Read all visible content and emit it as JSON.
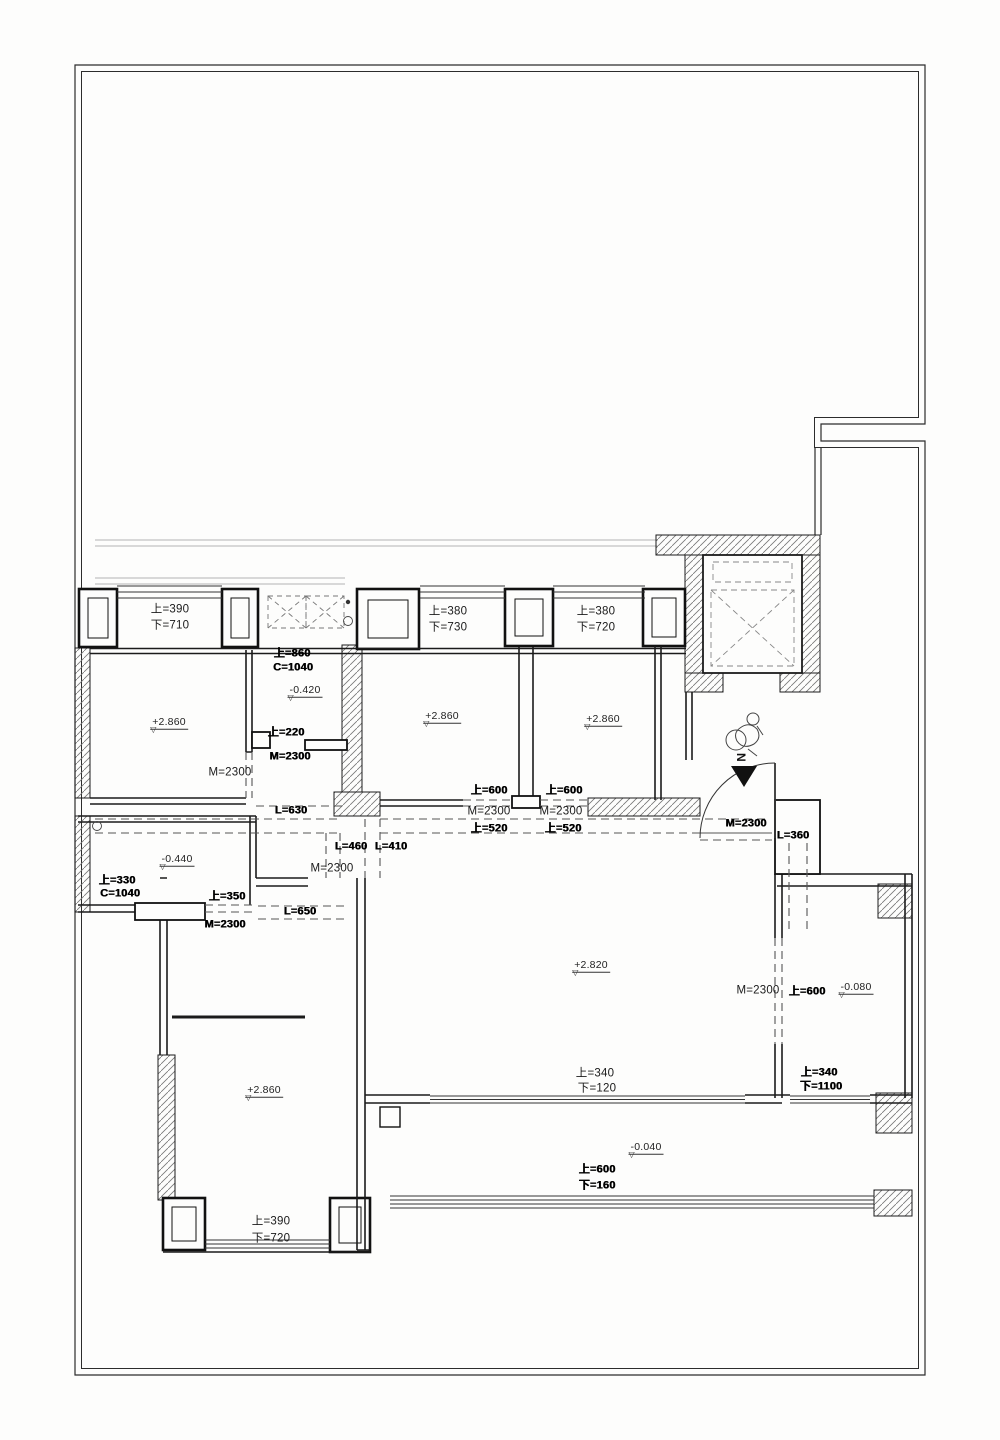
{
  "page": {
    "width": 1000,
    "height": 1440,
    "background": "#fdfdfc",
    "line_color": "#1b1b1b",
    "dash_color": "#555555",
    "hatch_color": "#666666"
  },
  "plan": {
    "type": "architectural-floor-plan",
    "north_arrow": {
      "label": "N"
    },
    "icons": [
      {
        "name": "north-arrow-icon",
        "meaning": "north direction arrow"
      },
      {
        "name": "person-figure-icon",
        "meaning": "entry person sketch"
      },
      {
        "name": "elevator-cross",
        "meaning": "elevator shaft with diagonal cross"
      }
    ],
    "annotations": [
      {
        "name": "window-sill-label",
        "text": "上=390",
        "x": 170,
        "y": 610,
        "style": "normal"
      },
      {
        "name": "window-sill-label",
        "text": "下=710",
        "x": 170,
        "y": 626,
        "style": "normal"
      },
      {
        "name": "window-sill-label",
        "text": "上=380",
        "x": 448,
        "y": 612,
        "style": "normal"
      },
      {
        "name": "window-sill-label",
        "text": "下=730",
        "x": 448,
        "y": 628,
        "style": "normal"
      },
      {
        "name": "window-sill-label",
        "text": "上=380",
        "x": 596,
        "y": 612,
        "style": "normal"
      },
      {
        "name": "window-sill-label",
        "text": "下=720",
        "x": 596,
        "y": 628,
        "style": "normal"
      },
      {
        "name": "opening-label",
        "text": "上=860",
        "x": 292,
        "y": 654,
        "style": "bold"
      },
      {
        "name": "opening-label",
        "text": "C=1040",
        "x": 293,
        "y": 668,
        "style": "bold"
      },
      {
        "name": "elevation-label",
        "text": "-0.420",
        "x": 305,
        "y": 691,
        "style": "elevation"
      },
      {
        "name": "elevation-label",
        "text": "+2.860",
        "x": 169,
        "y": 723,
        "style": "elevation"
      },
      {
        "name": "elevation-label",
        "text": "+2.860",
        "x": 442,
        "y": 717,
        "style": "elevation"
      },
      {
        "name": "elevation-label",
        "text": "+2.860",
        "x": 603,
        "y": 720,
        "style": "elevation"
      },
      {
        "name": "opening-label",
        "text": "上=220",
        "x": 286,
        "y": 733,
        "style": "bold"
      },
      {
        "name": "door-height-label",
        "text": "M=2300",
        "x": 290,
        "y": 757,
        "style": "bold"
      },
      {
        "name": "door-height-label",
        "text": "M=2300",
        "x": 230,
        "y": 773,
        "style": "normal"
      },
      {
        "name": "lintel-label",
        "text": "L=630",
        "x": 291,
        "y": 811,
        "style": "bold"
      },
      {
        "name": "opening-label",
        "text": "上=600",
        "x": 489,
        "y": 791,
        "style": "bold"
      },
      {
        "name": "door-height-label",
        "text": "M=2300",
        "x": 489,
        "y": 812,
        "style": "normal"
      },
      {
        "name": "opening-label",
        "text": "上=520",
        "x": 489,
        "y": 829,
        "style": "bold"
      },
      {
        "name": "opening-label",
        "text": "上=600",
        "x": 564,
        "y": 791,
        "style": "bold"
      },
      {
        "name": "door-height-label",
        "text": "M=2300",
        "x": 561,
        "y": 812,
        "style": "normal"
      },
      {
        "name": "opening-label",
        "text": "上=520",
        "x": 563,
        "y": 829,
        "style": "bold"
      },
      {
        "name": "door-height-label",
        "text": "M=2300",
        "x": 746,
        "y": 824,
        "style": "bold"
      },
      {
        "name": "lintel-label",
        "text": "L=360",
        "x": 793,
        "y": 836,
        "style": "bold"
      },
      {
        "name": "elevation-label",
        "text": "-0.440",
        "x": 177,
        "y": 860,
        "style": "elevation"
      },
      {
        "name": "opening-label",
        "text": "上=330",
        "x": 117,
        "y": 881,
        "style": "bold"
      },
      {
        "name": "opening-label",
        "text": "C=1040",
        "x": 120,
        "y": 894,
        "style": "bold"
      },
      {
        "name": "opening-label",
        "text": "上=350",
        "x": 227,
        "y": 897,
        "style": "bold"
      },
      {
        "name": "door-height-label",
        "text": "M=2300",
        "x": 225,
        "y": 925,
        "style": "bold"
      },
      {
        "name": "lintel-label",
        "text": "L=460",
        "x": 351,
        "y": 847,
        "style": "bold"
      },
      {
        "name": "lintel-label",
        "text": "L=410",
        "x": 391,
        "y": 847,
        "style": "bold"
      },
      {
        "name": "door-height-label",
        "text": "M=2300",
        "x": 332,
        "y": 869,
        "style": "normal"
      },
      {
        "name": "lintel-label",
        "text": "L=650",
        "x": 300,
        "y": 912,
        "style": "bold"
      },
      {
        "name": "elevation-label",
        "text": "+2.820",
        "x": 591,
        "y": 966,
        "style": "elevation"
      },
      {
        "name": "door-height-label",
        "text": "M=2300",
        "x": 758,
        "y": 991,
        "style": "normal"
      },
      {
        "name": "opening-label",
        "text": "上=600",
        "x": 807,
        "y": 992,
        "style": "bold"
      },
      {
        "name": "elevation-label",
        "text": "-0.080",
        "x": 856,
        "y": 988,
        "style": "elevation"
      },
      {
        "name": "opening-label",
        "text": "上=340",
        "x": 819,
        "y": 1073,
        "style": "bold"
      },
      {
        "name": "opening-label",
        "text": "下=1100",
        "x": 821,
        "y": 1087,
        "style": "bold"
      },
      {
        "name": "opening-label",
        "text": "上=340",
        "x": 595,
        "y": 1074,
        "style": "normal"
      },
      {
        "name": "opening-label",
        "text": "下=120",
        "x": 597,
        "y": 1089,
        "style": "normal"
      },
      {
        "name": "elevation-label",
        "text": "+2.860",
        "x": 264,
        "y": 1091,
        "style": "elevation"
      },
      {
        "name": "elevation-label",
        "text": "-0.040",
        "x": 646,
        "y": 1148,
        "style": "elevation"
      },
      {
        "name": "opening-label",
        "text": "上=600",
        "x": 597,
        "y": 1170,
        "style": "bold"
      },
      {
        "name": "opening-label",
        "text": "下=160",
        "x": 597,
        "y": 1186,
        "style": "bold"
      },
      {
        "name": "window-sill-label",
        "text": "上=390",
        "x": 271,
        "y": 1222,
        "style": "normal"
      },
      {
        "name": "window-sill-label",
        "text": "下=720",
        "x": 271,
        "y": 1239,
        "style": "normal"
      }
    ]
  }
}
